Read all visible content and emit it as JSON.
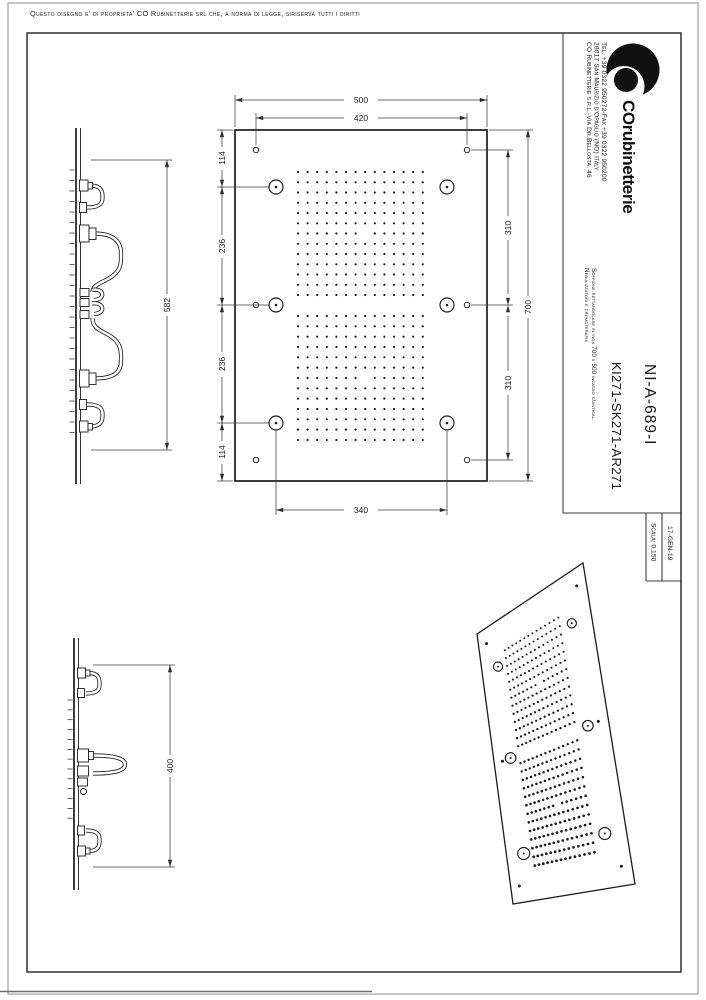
{
  "page": {
    "disclaimer": "Questo disegno e' di proprieta' CO Rubinetterie srl che, a norma di legge, siriserva tutti i diritti"
  },
  "title_block": {
    "company": {
      "address_line1": "CO Rubinetterie s.r.l.-Via Dr.Bellosta, 46",
      "address_line2": "28017 San Maurizio d'Opaglio (NO) Italy",
      "address_line3": "Tel. +39 0322 950272-Fax +39 0322 950200",
      "logo_text": "COrubinetterie"
    },
    "description_line1": "Soffione rettangolare in inox 700 x 500 incasso c/antical.",
    "description_line2": "Nebulizzatori e cromoterapia",
    "product_code": "KI271-SK271-AR271",
    "drawing_number": "NI-A-689-I",
    "scale": "Scala: 0.150",
    "date": "17-GEN-19"
  },
  "plan_view": {
    "dim_overall_width": "500",
    "dim_hole_spacing_w": "420",
    "dim_top": "114",
    "dim_mid_upper": "236",
    "dim_mid_lower": "236",
    "dim_bottom": "114",
    "dim_right_upper": "310",
    "dim_right_lower": "310",
    "dim_overall_height": "700",
    "dim_nozzle_spacing": "340"
  },
  "side_view_long": {
    "dim_connections_span": "582"
  },
  "side_view_short": {
    "dim_connections_span": "400"
  },
  "colors": {
    "line": "#1c1c1c",
    "dim_line": "#3c3c3c",
    "background": "#ffffff"
  }
}
